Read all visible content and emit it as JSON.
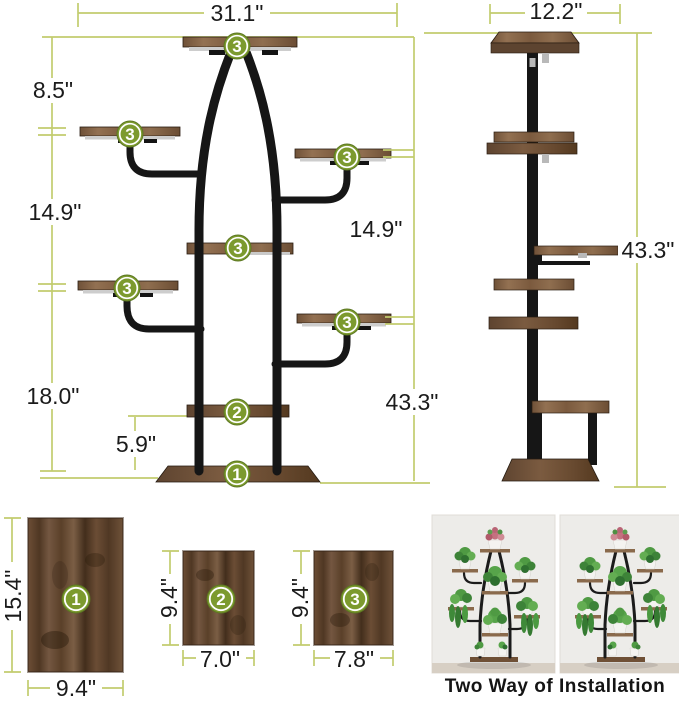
{
  "front_view": {
    "width": "31.1\"",
    "seg_top": "8.5\"",
    "seg_left_mid": "14.9\"",
    "seg_right_mid": "14.9\"",
    "seg_left_bottom": "18.0\"",
    "seg_shelf2_base": "5.9\"",
    "total_height": "43.3\""
  },
  "side_view": {
    "depth": "12.2\"",
    "total_height": "43.3\""
  },
  "badges": {
    "b1": "1",
    "b2": "2",
    "b3": "3"
  },
  "boards": [
    {
      "badge": "1",
      "height": "15.4\"",
      "width": "9.4\""
    },
    {
      "badge": "2",
      "height": "9.4\"",
      "width": "7.0\""
    },
    {
      "badge": "3",
      "height": "9.4\"",
      "width": "7.8\""
    }
  ],
  "caption": "Two Way of Installation",
  "colors": {
    "dimension_line": "#c2cc6e",
    "badge_green": "#7c9a2e",
    "frame_black": "#161616",
    "wood_brown": "#8a6a4c",
    "board_brown": "#5f4530"
  }
}
